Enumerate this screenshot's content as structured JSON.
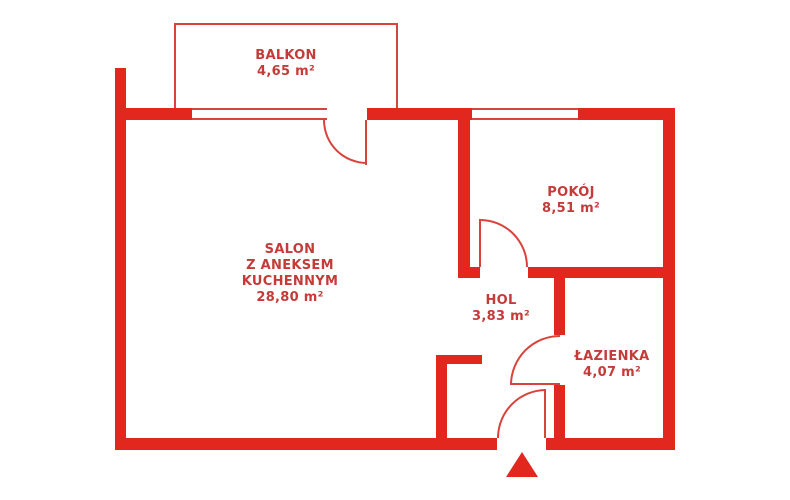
{
  "title": "Apartment floor plan",
  "colors": {
    "wall": "#e2271f",
    "line": "#d8433c",
    "text": "#c43b38",
    "background": "#ffffff"
  },
  "rooms": {
    "balkon": {
      "name": "BALKON",
      "area": "4,65 m²"
    },
    "salon": {
      "name_lines": [
        "SALON",
        "Z ANEKSEM",
        "KUCHENNYM"
      ],
      "area": "28,80 m²"
    },
    "pokoj": {
      "name": "POKÓJ",
      "area": "8,51 m²"
    },
    "hol": {
      "name": "HOL",
      "area": "3,83 m²"
    },
    "lazienka": {
      "name": "ŁAZIENKA",
      "area": "4,07 m²"
    }
  },
  "icons": {
    "entrance": "entrance-arrow-icon"
  }
}
